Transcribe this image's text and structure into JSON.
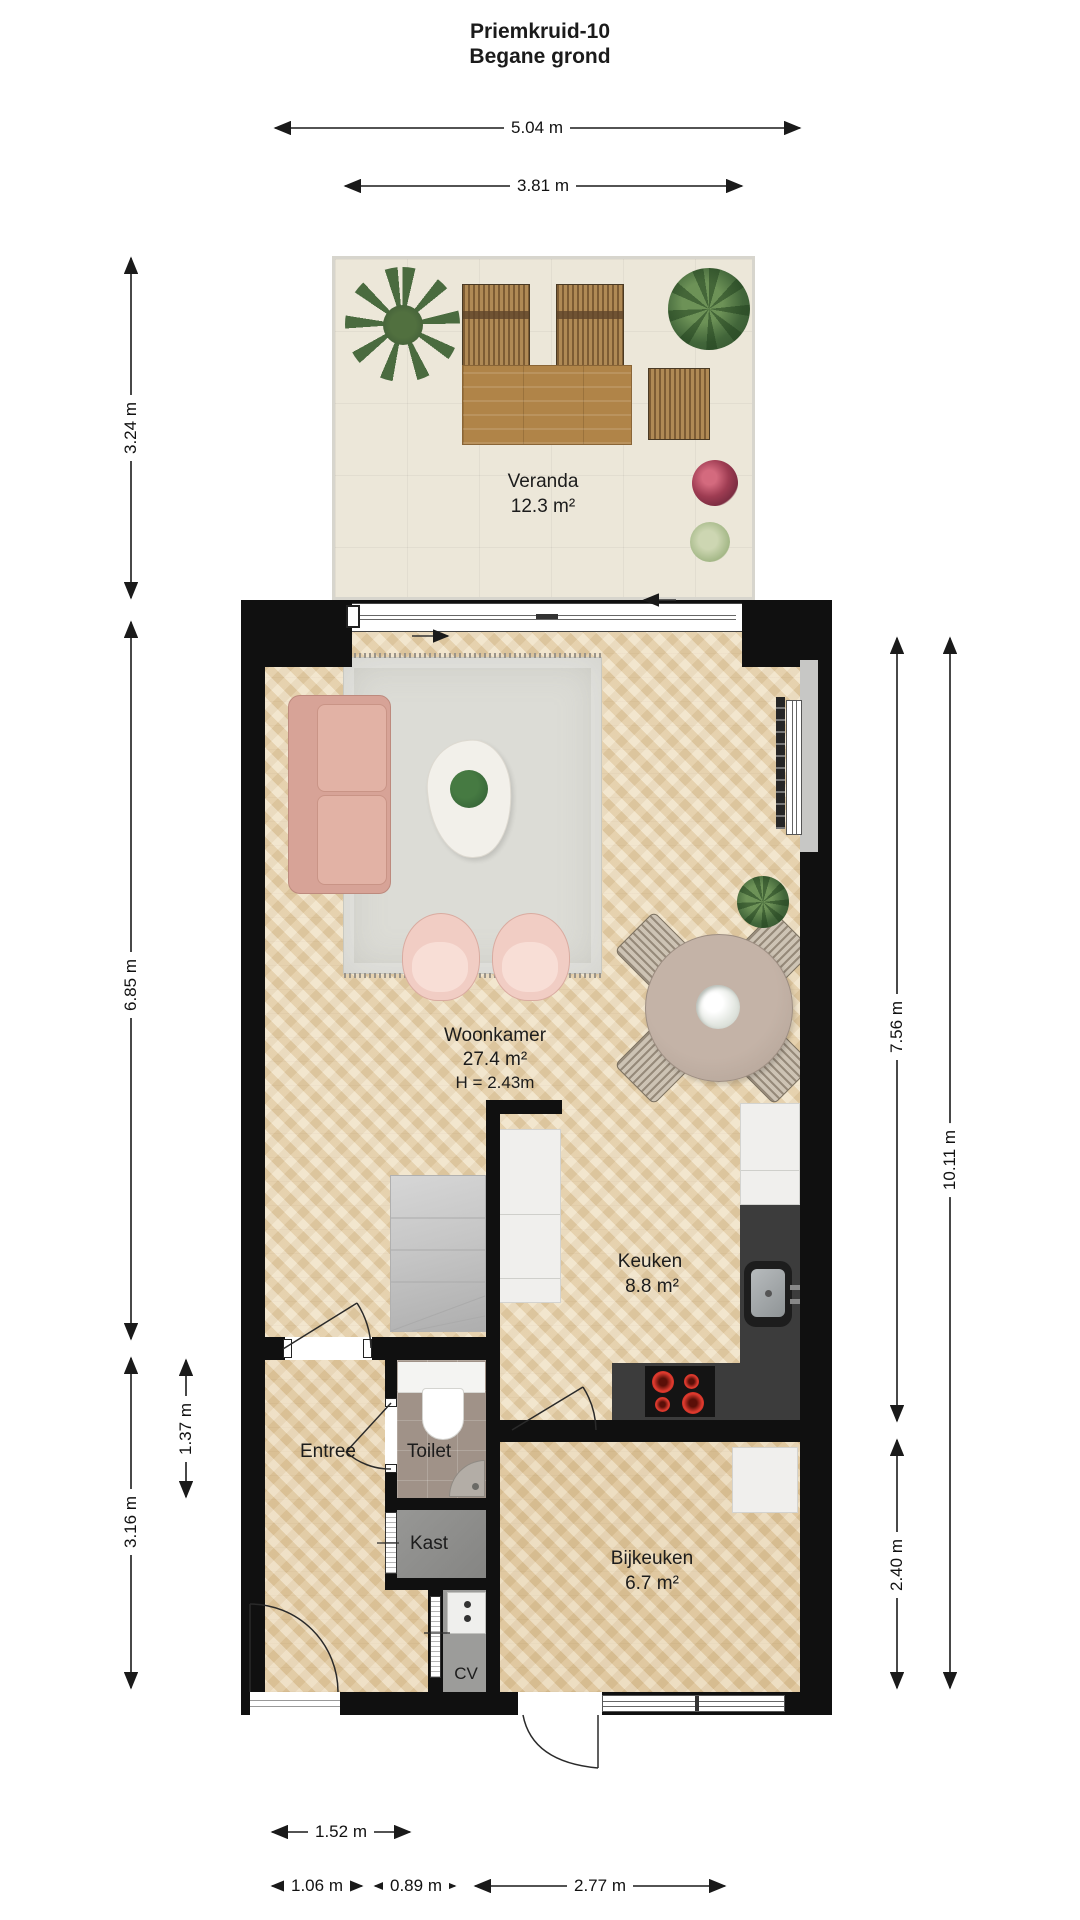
{
  "title": {
    "line1": "Priemkruid-10",
    "line2": "Begane grond"
  },
  "rooms": {
    "veranda": {
      "name": "Veranda",
      "area": "12.3 m²"
    },
    "woonkamer": {
      "name": "Woonkamer",
      "area": "27.4 m²",
      "ceiling": "H = 2.43m"
    },
    "keuken": {
      "name": "Keuken",
      "area": "8.8 m²"
    },
    "entree": {
      "name": "Entree"
    },
    "toilet": {
      "name": "Toilet"
    },
    "kast": {
      "name": "Kast"
    },
    "cv": {
      "name": "CV"
    },
    "bijkeuken": {
      "name": "Bijkeuken",
      "area": "6.7 m²"
    }
  },
  "dimensions": {
    "top_total": "5.04 m",
    "top_veranda": "3.81 m",
    "left_veranda": "3.24 m",
    "left_main": "6.85 m",
    "left_toilet": "1.37 m",
    "left_lower": "3.16 m",
    "right_upper": "7.56 m",
    "right_total": "10.11 m",
    "right_lower": "2.40 m",
    "bottom_entree": "1.52 m",
    "bottom_left": "1.06 m",
    "bottom_mid": "0.89 m",
    "bottom_right": "2.77 m"
  },
  "colors": {
    "wall": "#101010",
    "wood_floor": "#ecd9b6",
    "veranda_floor": "#ece7d9",
    "sofa_pink": "#d7a397",
    "counter_dark": "#3c3c3c",
    "burner_red": "#c8281c",
    "dim_line": "#1a1a1a"
  }
}
